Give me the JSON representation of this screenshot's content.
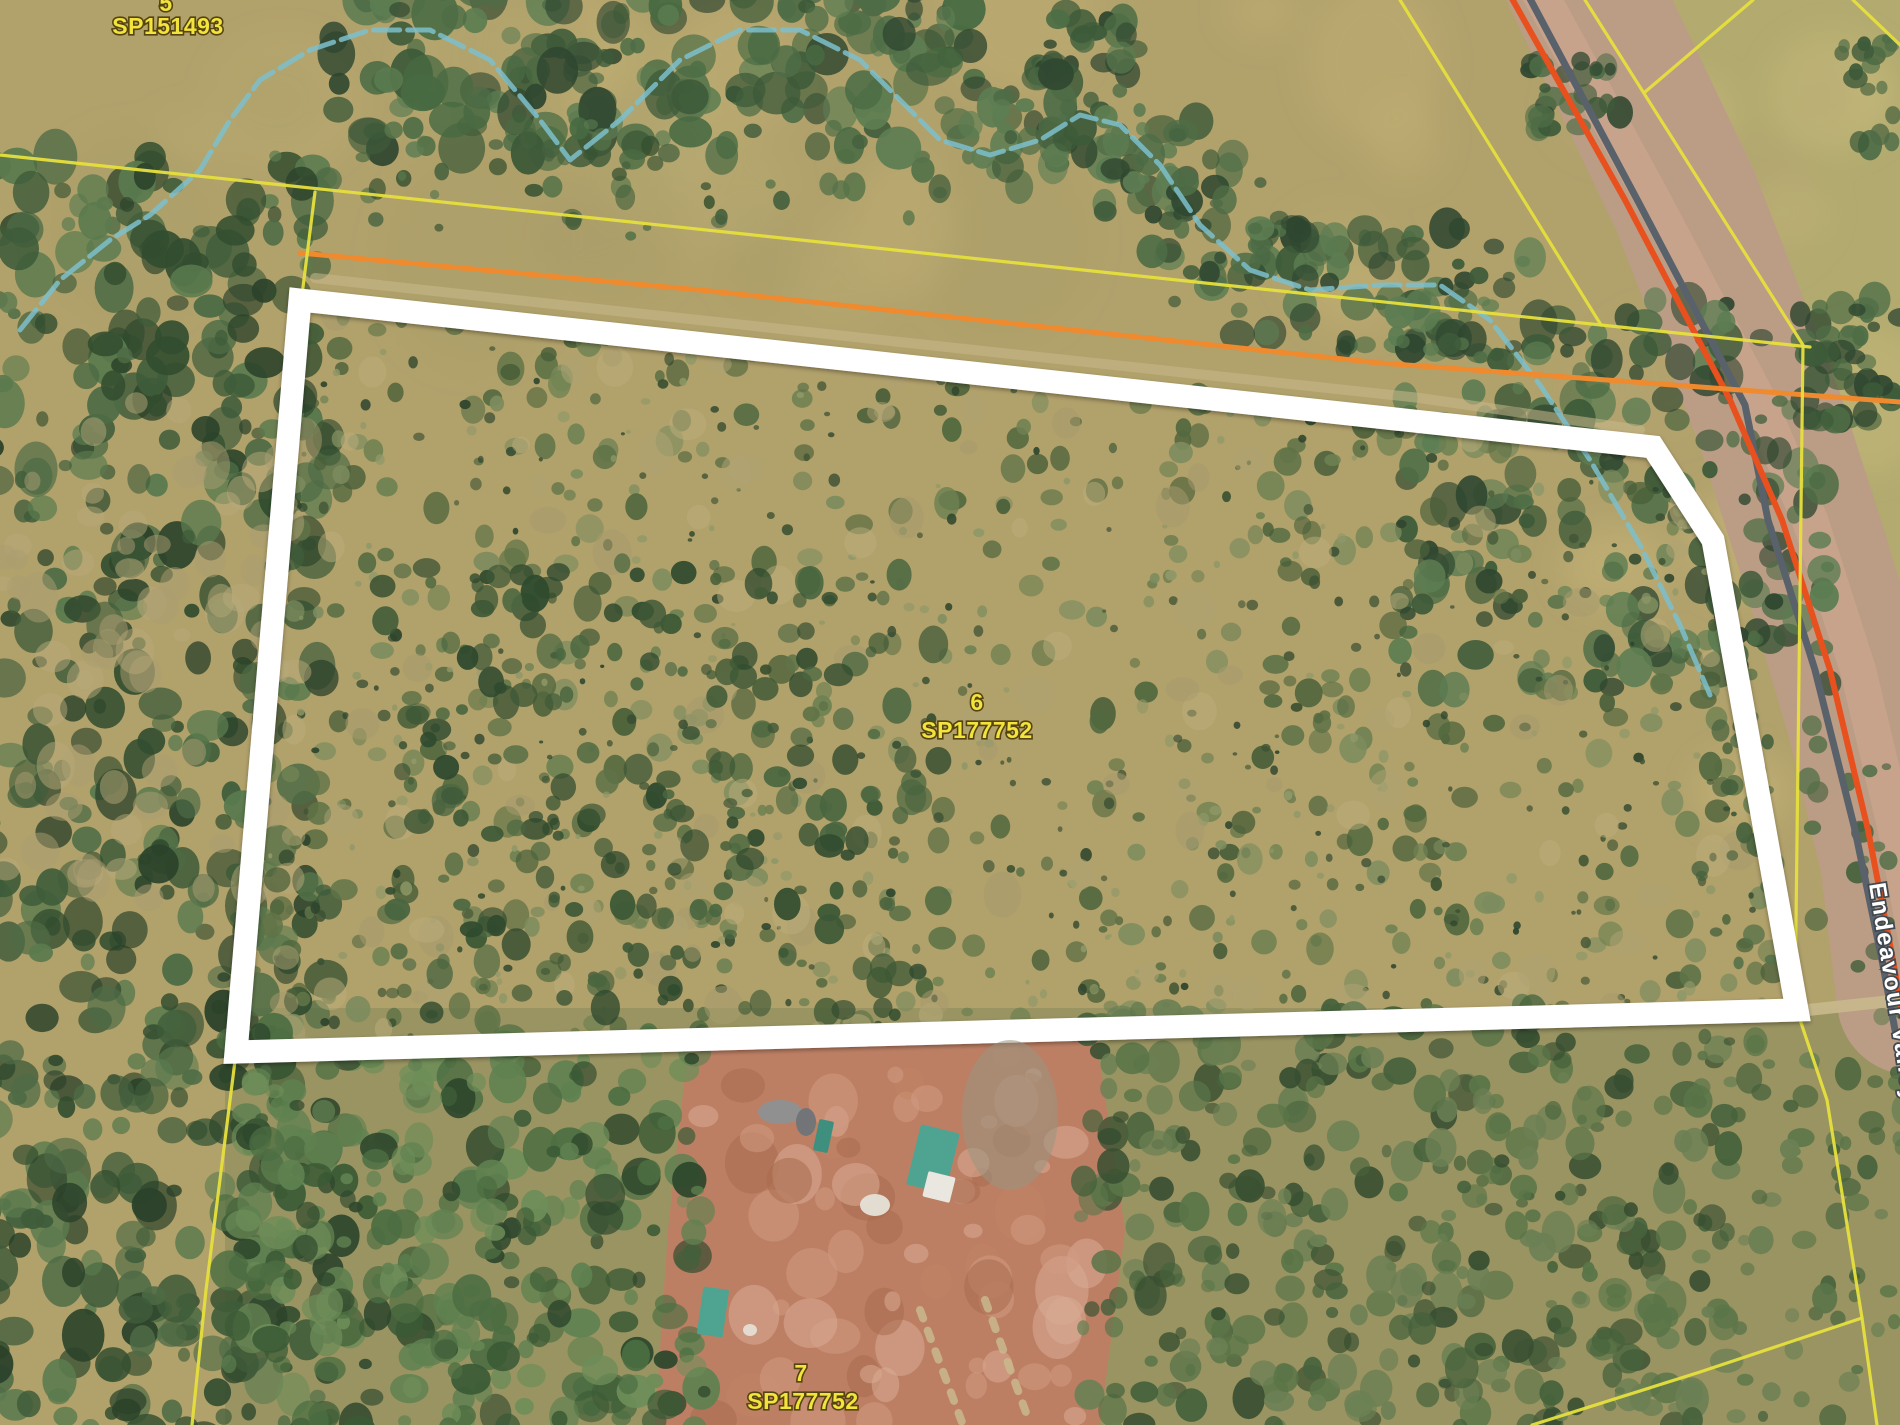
{
  "colors": {
    "terrain_base": "#b1a16b",
    "south_scrub_base": "#9a9462",
    "east_field": "#b3ab70",
    "clearing_fill": "#bd7f64",
    "property_boundary": "#ffffff",
    "cadastral_yellow": "#e6df3d",
    "utility_orange": "#ef8a2e",
    "road_red": "#e8501e",
    "road_gray": "#59616b",
    "road_corridor": "#bb9c85",
    "road_shoulder": "#cba58d",
    "creek_teal": "#7cc0cd",
    "track_tan": "#c9b98d",
    "label_yellow": "#f2e43c",
    "label_outline": "#564410",
    "road_label": "#ffffff",
    "road_label_outline": "#41484f",
    "shed_teal": "#4fa391",
    "shed_teal_dark": "#3f8f7e"
  },
  "labels": {
    "parcel_top_left": {
      "lot": "5",
      "plan": "SP151493",
      "lot_x": 166,
      "lot_y": 11,
      "plan_x": 168,
      "plan_y": 34
    },
    "parcel_center": {
      "lot": "6",
      "plan": "SP177752",
      "lot_x": 977,
      "lot_y": 710,
      "plan_x": 977,
      "plan_y": 738
    },
    "parcel_bottom": {
      "lot": "7",
      "plan": "SP177752",
      "lot_x": 801,
      "lot_y": 1381,
      "plan_x": 803,
      "plan_y": 1409
    },
    "road": {
      "name": "Endeavour Valley Rd",
      "x": 1869,
      "y": 884,
      "rotation": 81
    }
  },
  "boundary": {
    "points": [
      [
        300,
        300
      ],
      [
        1653,
        447
      ],
      [
        1713,
        540
      ],
      [
        1797,
        1010
      ],
      [
        236,
        1052
      ]
    ],
    "width": 23
  },
  "cadastral_lines": [
    {
      "name": "north-boundary-line",
      "points": [
        [
          0,
          155
        ],
        [
          1601,
          325
        ],
        [
          1810,
          347
        ]
      ]
    },
    {
      "name": "road-west-line",
      "points": [
        [
          1400,
          0
        ],
        [
          1601,
          325
        ]
      ]
    },
    {
      "name": "road-east-line",
      "points": [
        [
          1585,
          0
        ],
        [
          1803,
          345
        ],
        [
          1795,
          1005
        ],
        [
          1827,
          1100
        ],
        [
          1862,
          1318
        ],
        [
          1877,
          1425
        ]
      ]
    },
    {
      "name": "field-corner-line",
      "points": [
        [
          1753,
          0
        ],
        [
          1645,
          92
        ]
      ]
    },
    {
      "name": "topright-corner-line",
      "points": [
        [
          1853,
          0
        ],
        [
          1900,
          45
        ]
      ]
    },
    {
      "name": "west-connector-line",
      "points": [
        [
          315,
          192
        ],
        [
          302,
          295
        ]
      ]
    },
    {
      "name": "southwest-line",
      "points": [
        [
          236,
          1053
        ],
        [
          206,
          1290
        ],
        [
          192,
          1425
        ]
      ]
    },
    {
      "name": "southeast-branch-line",
      "points": [
        [
          1862,
          1318
        ],
        [
          1700,
          1372
        ],
        [
          1532,
          1425
        ]
      ]
    }
  ],
  "utility_line": {
    "points": [
      [
        300,
        253
      ],
      [
        700,
        290
      ],
      [
        1380,
        363
      ],
      [
        1900,
        402
      ]
    ],
    "width": 5
  },
  "creek": {
    "points": [
      [
        20,
        330
      ],
      [
        60,
        280
      ],
      [
        110,
        240
      ],
      [
        150,
        215
      ],
      [
        200,
        170
      ],
      [
        230,
        120
      ],
      [
        260,
        80
      ],
      [
        310,
        50
      ],
      [
        370,
        30
      ],
      [
        430,
        30
      ],
      [
        490,
        60
      ],
      [
        540,
        120
      ],
      [
        570,
        160
      ],
      [
        620,
        120
      ],
      [
        680,
        60
      ],
      [
        740,
        30
      ],
      [
        800,
        30
      ],
      [
        860,
        60
      ],
      [
        900,
        100
      ],
      [
        940,
        140
      ],
      [
        990,
        155
      ],
      [
        1040,
        140
      ],
      [
        1080,
        115
      ],
      [
        1120,
        125
      ],
      [
        1160,
        165
      ],
      [
        1200,
        225
      ],
      [
        1250,
        270
      ],
      [
        1310,
        290
      ],
      [
        1380,
        285
      ],
      [
        1440,
        285
      ],
      [
        1490,
        320
      ],
      [
        1540,
        385
      ],
      [
        1590,
        460
      ],
      [
        1640,
        545
      ],
      [
        1680,
        625
      ],
      [
        1710,
        695
      ]
    ],
    "width": 5,
    "dash": "26 8",
    "opacity": 0.85
  },
  "road": {
    "corridor": {
      "points": [
        [
          1575,
          -30
        ],
        [
          1685,
          200
        ],
        [
          1770,
          420
        ],
        [
          1815,
          560
        ],
        [
          1862,
          720
        ],
        [
          1895,
          860
        ],
        [
          1912,
          1000
        ]
      ],
      "width": 150
    },
    "shoulder": {
      "points": [
        [
          1538,
          -10
        ],
        [
          1653,
          200
        ],
        [
          1758,
          400
        ],
        [
          1810,
          520
        ],
        [
          1858,
          670
        ],
        [
          1896,
          830
        ],
        [
          1920,
          960
        ]
      ],
      "width": 36,
      "opacity": 0.8
    },
    "red_line": {
      "points": [
        [
          1510,
          -5
        ],
        [
          1625,
          200
        ],
        [
          1730,
          400
        ],
        [
          1782,
          520
        ],
        [
          1830,
          670
        ],
        [
          1868,
          830
        ],
        [
          1893,
          960
        ],
        [
          1905,
          1030
        ]
      ],
      "width": 6
    },
    "gray_line": {
      "points": [
        [
          1528,
          -5
        ],
        [
          1640,
          205
        ],
        [
          1745,
          405
        ],
        [
          1768,
          520
        ],
        [
          1815,
          670
        ],
        [
          1855,
          830
        ],
        [
          1882,
          960
        ],
        [
          1895,
          1030
        ]
      ],
      "width": 7
    }
  },
  "tracks": [
    {
      "name": "track-above-north-edge",
      "points": [
        [
          315,
          278
        ],
        [
          900,
          342
        ],
        [
          1420,
          398
        ],
        [
          1640,
          430
        ]
      ],
      "width": 10,
      "opacity": 0.55
    },
    {
      "name": "track-to-road",
      "points": [
        [
          1790,
          1012
        ],
        [
          1900,
          1000
        ]
      ],
      "width": 12,
      "opacity": 0.9
    },
    {
      "name": "clearing-track-1",
      "points": [
        [
          920,
          1310
        ],
        [
          963,
          1425
        ]
      ],
      "width": 8,
      "dash": "9 13",
      "opacity": 0.85
    },
    {
      "name": "clearing-track-2",
      "points": [
        [
          985,
          1300
        ],
        [
          1028,
          1418
        ]
      ],
      "width": 8,
      "dash": "9 13",
      "opacity": 0.85
    }
  ],
  "farm": {
    "clearing": [
      [
        688,
        1048
      ],
      [
        1095,
        1030
      ],
      [
        1125,
        1230
      ],
      [
        1100,
        1425
      ],
      [
        655,
        1425
      ],
      [
        668,
        1230
      ]
    ],
    "buildings": [
      {
        "name": "main-shed-roof",
        "x": 913,
        "y": 1128,
        "w": 40,
        "h": 62,
        "rot": 14,
        "color": "shed_teal"
      },
      {
        "name": "main-shed-annex",
        "x": 925,
        "y": 1174,
        "w": 28,
        "h": 26,
        "rot": 14,
        "color": "#e9e7e0"
      },
      {
        "name": "small-shed",
        "x": 816,
        "y": 1120,
        "w": 15,
        "h": 32,
        "rot": 12,
        "color": "shed_teal_dark"
      },
      {
        "name": "south-shed",
        "x": 700,
        "y": 1288,
        "w": 26,
        "h": 48,
        "rot": 8,
        "color": "shed_teal"
      }
    ],
    "junk": [
      {
        "cx": 780,
        "cy": 1112,
        "rx": 22,
        "ry": 12,
        "fill": "#8e9194",
        "opacity": 0.95
      },
      {
        "cx": 806,
        "cy": 1122,
        "rx": 10,
        "ry": 14,
        "fill": "#6f7478",
        "opacity": 0.95
      },
      {
        "cx": 875,
        "cy": 1205,
        "rx": 15,
        "ry": 11,
        "fill": "#e6e2d8",
        "opacity": 0.95
      },
      {
        "cx": 750,
        "cy": 1330,
        "rx": 7,
        "ry": 6,
        "fill": "#e6e2d8",
        "opacity": 0.9
      },
      {
        "cx": 1010,
        "cy": 1115,
        "rx": 48,
        "ry": 75,
        "fill": "#99937f",
        "opacity": 0.55
      }
    ]
  },
  "base_regions": [
    {
      "name": "grassland-base",
      "rect": [
        0,
        0,
        1900,
        1425
      ],
      "color": "terrain_base"
    },
    {
      "name": "south-scrub-base",
      "rect": [
        225,
        1008,
        1675,
        417
      ],
      "color": "south_scrub_base"
    },
    {
      "name": "east-field",
      "polygon": [
        [
          1620,
          0
        ],
        [
          1900,
          0
        ],
        [
          1900,
          1030
        ],
        [
          1760,
          440
        ]
      ],
      "color": "east_field",
      "opacity": 0.9
    }
  ],
  "texture_regions": [
    {
      "name": "grass-blotch",
      "seed": 21,
      "bounds": [
        0,
        0,
        1500,
        300
      ],
      "count": 24,
      "rmin": 35,
      "rmax": 95,
      "colors": [
        "#c2b176",
        "#a99d68",
        "#baac72"
      ],
      "opacity": 0.4,
      "blur": true
    },
    {
      "name": "field-blotch",
      "seed": 22,
      "bounds": [
        1600,
        0,
        300,
        900
      ],
      "count": 16,
      "rmin": 30,
      "rmax": 80,
      "colors": [
        "#cabb7e",
        "#b4a670"
      ],
      "opacity": 0.4,
      "blur": true
    },
    {
      "name": "clearing-mottle",
      "seed": 30,
      "bounds": [
        690,
        1050,
        400,
        375
      ],
      "count": 70,
      "rmin": 8,
      "rmax": 28,
      "colors": [
        "#cf9a81",
        "#aa6c4f",
        "#d8ab93",
        "#c18365"
      ],
      "opacity": 0.55,
      "layer": "clearing"
    },
    {
      "name": "top-band",
      "seed": 11,
      "bounds": [
        325,
        -15,
        650,
        175
      ],
      "count": 185,
      "rmin": 7,
      "rmax": 24,
      "colors": [
        "#3d5a39",
        "#2f4730",
        "#4e6d46",
        "#5d7d52",
        "#486a42"
      ]
    },
    {
      "name": "top-band-scatter",
      "seed": 12,
      "bounds": [
        350,
        130,
        620,
        110
      ],
      "count": 46,
      "rmin": 4,
      "rmax": 12,
      "colors": [
        "#44603e",
        "#567349",
        "#35502f"
      ]
    },
    {
      "name": "top-corner-cluster",
      "seed": 31,
      "bounds": [
        1030,
        0,
        110,
        75
      ],
      "count": 24,
      "rmin": 6,
      "rmax": 16,
      "colors": [
        "#3d5a39",
        "#2f4730",
        "#4e6d46"
      ]
    },
    {
      "name": "creek-belt",
      "seed": 13,
      "line_from": 20,
      "line_to": 30,
      "jitter": 60,
      "count": 185,
      "rmin": 6,
      "rmax": 18,
      "colors": [
        "#3d5a39",
        "#2f4730",
        "#4e6d46",
        "#5d7d52"
      ]
    },
    {
      "name": "east-trees",
      "seed": 14,
      "bounds": [
        1400,
        300,
        430,
        390
      ],
      "count": 200,
      "rmin": 6,
      "rmax": 19,
      "colors": [
        "#3d5a39",
        "#2f4730",
        "#4e6d46",
        "#5d7d52"
      ]
    },
    {
      "name": "left-forest",
      "seed": 15,
      "bounds": [
        -15,
        150,
        345,
        1290
      ],
      "count": 520,
      "rmin": 6,
      "rmax": 22,
      "colors": [
        "#324d2f",
        "#3f5c3a",
        "#4d6b45",
        "#5a7a4e",
        "#2b422a"
      ]
    },
    {
      "name": "left-forest-gaps",
      "seed": 16,
      "bounds": [
        0,
        400,
        300,
        500
      ],
      "count": 70,
      "rmin": 8,
      "rmax": 20,
      "colors": [
        "#ab9d72",
        "#b8a97a"
      ],
      "opacity": 0.5
    },
    {
      "name": "interior-scrub",
      "seed": 17,
      "in_polygon": true,
      "count": 560,
      "rmin": 4,
      "rmax": 14,
      "colors": [
        "#5f7347",
        "#6e8152",
        "#52683f",
        "#7d8c5e",
        "#495f39"
      ]
    },
    {
      "name": "interior-speckle",
      "seed": 18,
      "in_polygon": true,
      "count": 420,
      "rmin": 2,
      "rmax": 6,
      "colors": [
        "#3c5132",
        "#8f9868",
        "#2e452d"
      ]
    },
    {
      "name": "interior-gaps",
      "seed": 19,
      "in_polygon": true,
      "count": 130,
      "rmin": 8,
      "rmax": 20,
      "colors": [
        "#b0a473",
        "#a89c6e",
        "#bcae7c"
      ],
      "opacity": 0.5
    },
    {
      "name": "interior-dense",
      "seed": 20,
      "bounds": [
        380,
        560,
        560,
        460
      ],
      "count": 230,
      "rmin": 5,
      "rmax": 15,
      "colors": [
        "#3d5836",
        "#4a6640",
        "#2f4a2e"
      ]
    },
    {
      "name": "roadside-cluster",
      "seed": 23,
      "bounds": [
        1530,
        55,
        95,
        75
      ],
      "count": 26,
      "rmin": 5,
      "rmax": 14,
      "colors": [
        "#3d5a39",
        "#2f4730",
        "#4e6d46"
      ]
    },
    {
      "name": "roadside-cluster2",
      "seed": 24,
      "bounds": [
        1798,
        295,
        105,
        135
      ],
      "count": 42,
      "rmin": 6,
      "rmax": 16,
      "colors": [
        "#3d5a39",
        "#2f4730",
        "#4e6d46"
      ]
    },
    {
      "name": "topright-corner-trees",
      "seed": 25,
      "bounds": [
        1838,
        35,
        70,
        120
      ],
      "count": 18,
      "rmin": 5,
      "rmax": 13,
      "colors": [
        "#3d5a39",
        "#4e6d46"
      ]
    },
    {
      "name": "south-mixed",
      "seed": 26,
      "bounds": [
        1080,
        1005,
        650,
        425
      ],
      "count": 400,
      "rmin": 5,
      "rmax": 17,
      "colors": [
        "#46623c",
        "#5a7548",
        "#384f31",
        "#6b8054"
      ]
    },
    {
      "name": "south-sparse",
      "seed": 27,
      "bounds": [
        1700,
        1005,
        205,
        425
      ],
      "count": 70,
      "rmin": 5,
      "rmax": 14,
      "colors": [
        "#46623c",
        "#5a7548",
        "#6b8054"
      ]
    },
    {
      "name": "south-left-forest",
      "seed": 28,
      "bounds": [
        225,
        1030,
        480,
        400
      ],
      "count": 330,
      "rmin": 6,
      "rmax": 20,
      "colors": [
        "#3a5a35",
        "#4c6e42",
        "#5f8150",
        "#2e472c",
        "#6d8d58"
      ]
    },
    {
      "name": "east-strip-scatter",
      "seed": 29,
      "bounds": [
        1700,
        690,
        190,
        310
      ],
      "count": 40,
      "rmin": 4,
      "rmax": 12,
      "colors": [
        "#56714a",
        "#44603c"
      ]
    }
  ]
}
